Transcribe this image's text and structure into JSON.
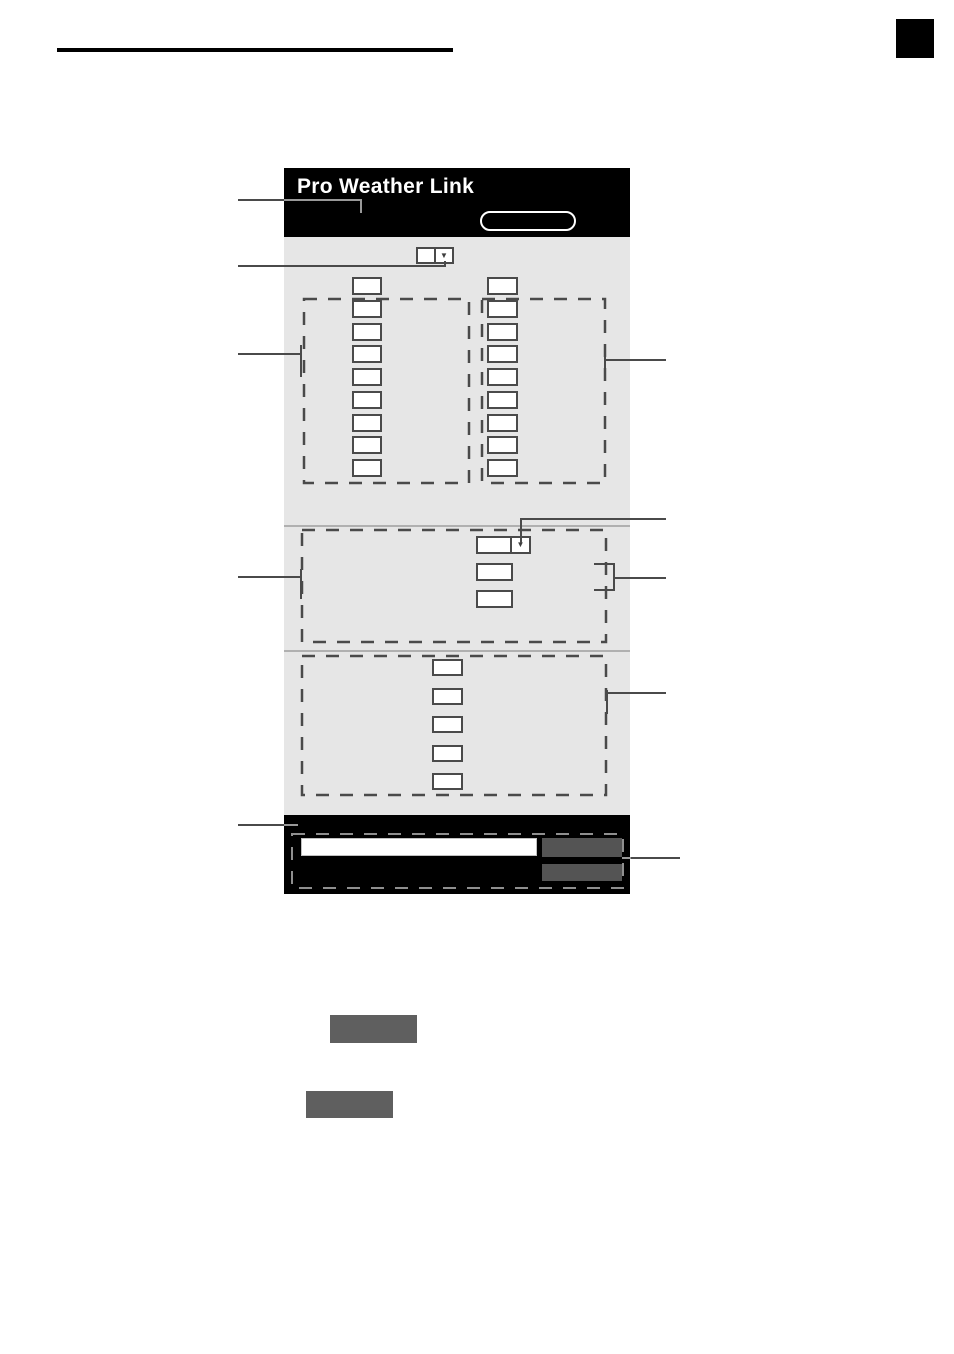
{
  "header": {
    "app_title": "Pro Weather Link"
  },
  "icons": {
    "dropdown_arrow": "▼"
  },
  "fields": {
    "station_column_left_count": 9,
    "station_column_right_count": 9,
    "section2_field_count": 2,
    "section3_field_count": 5
  },
  "colors": {
    "titlebar_bg": "#000000",
    "panel_bg": "#e6e6e6",
    "field_outline": "#4a4a4a",
    "footer_bg": "#000000",
    "footer_button_fill": "#545454",
    "illustrated_button_fill": "#5f5f5f"
  }
}
